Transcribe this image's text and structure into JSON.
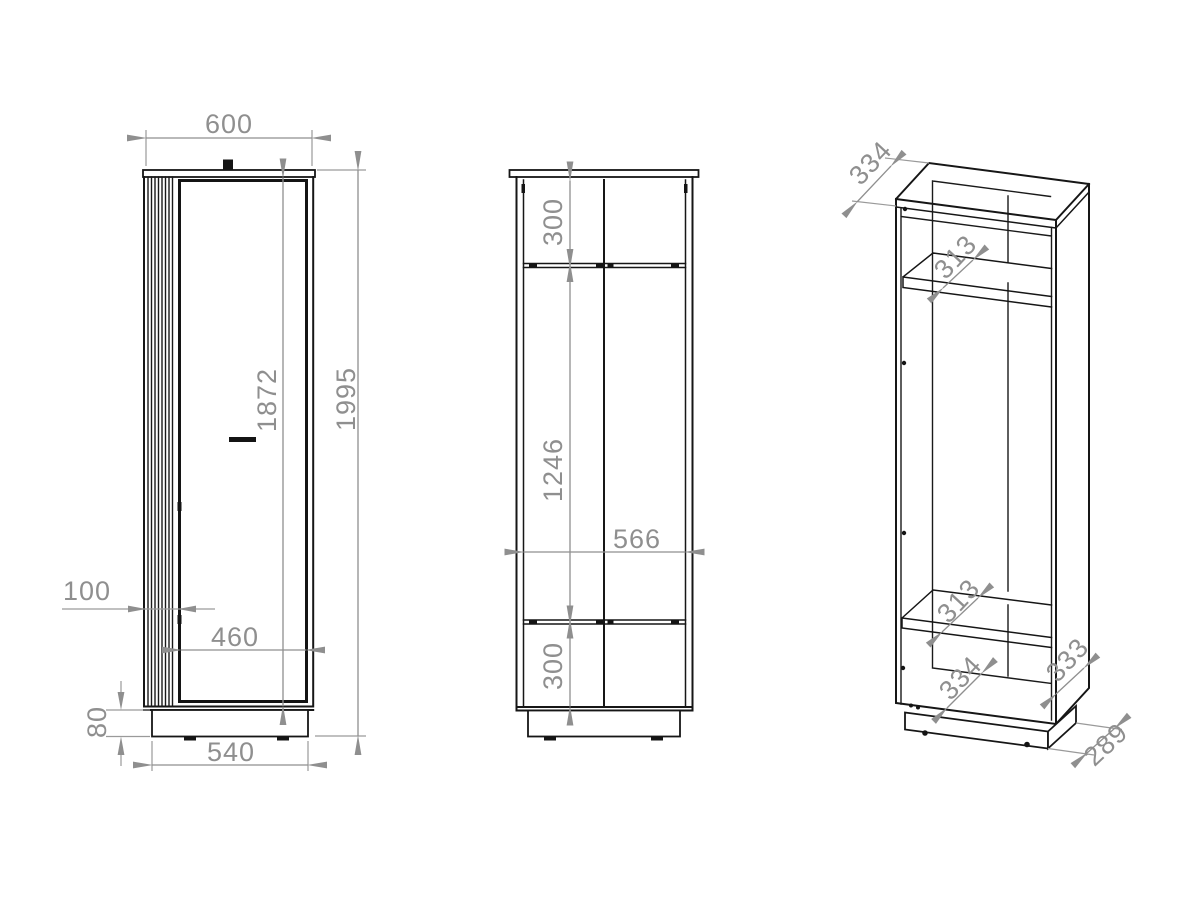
{
  "drawing": {
    "type": "furniture technical drawing, three views of a tall cabinet",
    "colors": {
      "background": "#ffffff",
      "object_line": "#161616",
      "dimension": "#8f8f8f"
    },
    "views": {
      "front": {
        "title": "front view",
        "dims": {
          "top_width": "600",
          "overall_height": "1995",
          "front_height": "1872",
          "slat_strip_width": "100",
          "door_width": "460",
          "plinth_height": "80",
          "plinth_width": "540"
        }
      },
      "rear": {
        "title": "rear/section view",
        "dims": {
          "top_compartment_height": "300",
          "middle_compartment_height": "1246",
          "interior_width": "566",
          "bottom_compartment_height": "300"
        }
      },
      "perspective": {
        "title": "perspective view",
        "dims": {
          "top_depth": "334",
          "upper_shelf_depth": "313",
          "lower_shelf_depth": "313",
          "bottom_depth": "334",
          "side_panel_depth": "333",
          "plinth_depth": "289"
        }
      }
    }
  }
}
